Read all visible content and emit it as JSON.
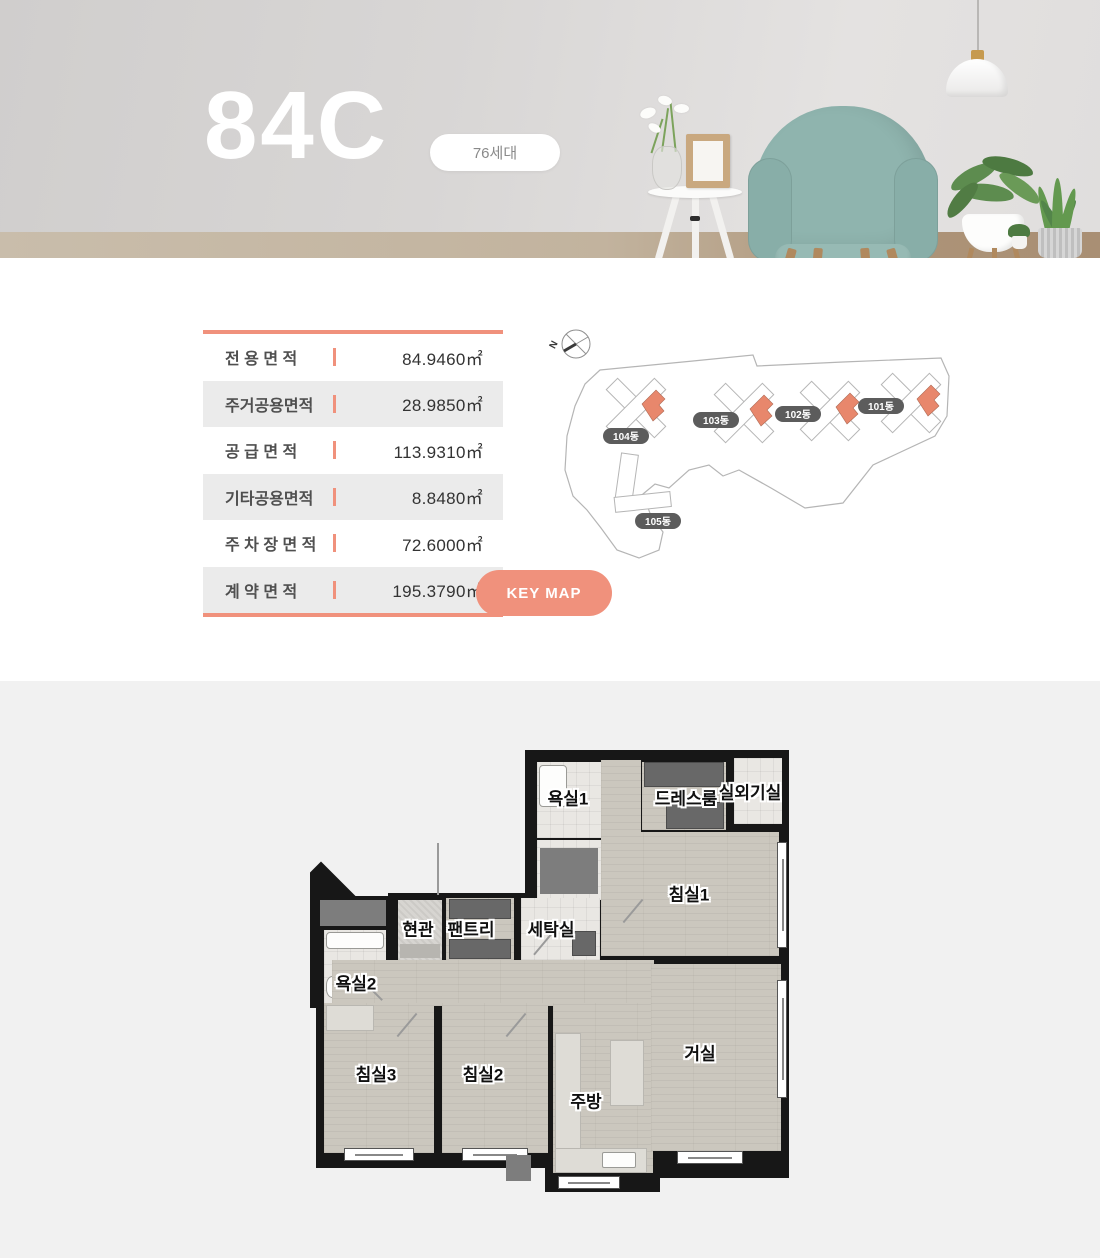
{
  "hero": {
    "title": "84C",
    "badge": "76세대"
  },
  "area_table": {
    "rows": [
      {
        "label": "전 용 면 적",
        "value": "84.9460㎡"
      },
      {
        "label": "주거공용면적",
        "value": "28.9850㎡"
      },
      {
        "label": "공 급 면 적",
        "value": "113.9310㎡"
      },
      {
        "label": "기타공용면적",
        "value": "8.8480㎡"
      },
      {
        "label": "주 차 장 면 적",
        "value": "72.6000㎡"
      },
      {
        "label": "계 약 면 적",
        "value": "195.3790㎡"
      }
    ]
  },
  "key_map": {
    "button_label": "KEY MAP",
    "compass_label": "N",
    "buildings": [
      {
        "label": "104동"
      },
      {
        "label": "103동"
      },
      {
        "label": "102동"
      },
      {
        "label": "101동"
      },
      {
        "label": "105동"
      }
    ]
  },
  "floor_plan": {
    "rooms": [
      {
        "label": "욕실1"
      },
      {
        "label": "드레스룸"
      },
      {
        "label": "실외기실"
      },
      {
        "label": "침실1"
      },
      {
        "label": "현관"
      },
      {
        "label": "팬트리"
      },
      {
        "label": "세탁실"
      },
      {
        "label": "욕실2"
      },
      {
        "label": "침실3"
      },
      {
        "label": "침실2"
      },
      {
        "label": "주방"
      },
      {
        "label": "거실"
      }
    ]
  },
  "colors": {
    "accent": "#f0917c",
    "map_highlight": "#e8876c",
    "wall": "#171717"
  }
}
